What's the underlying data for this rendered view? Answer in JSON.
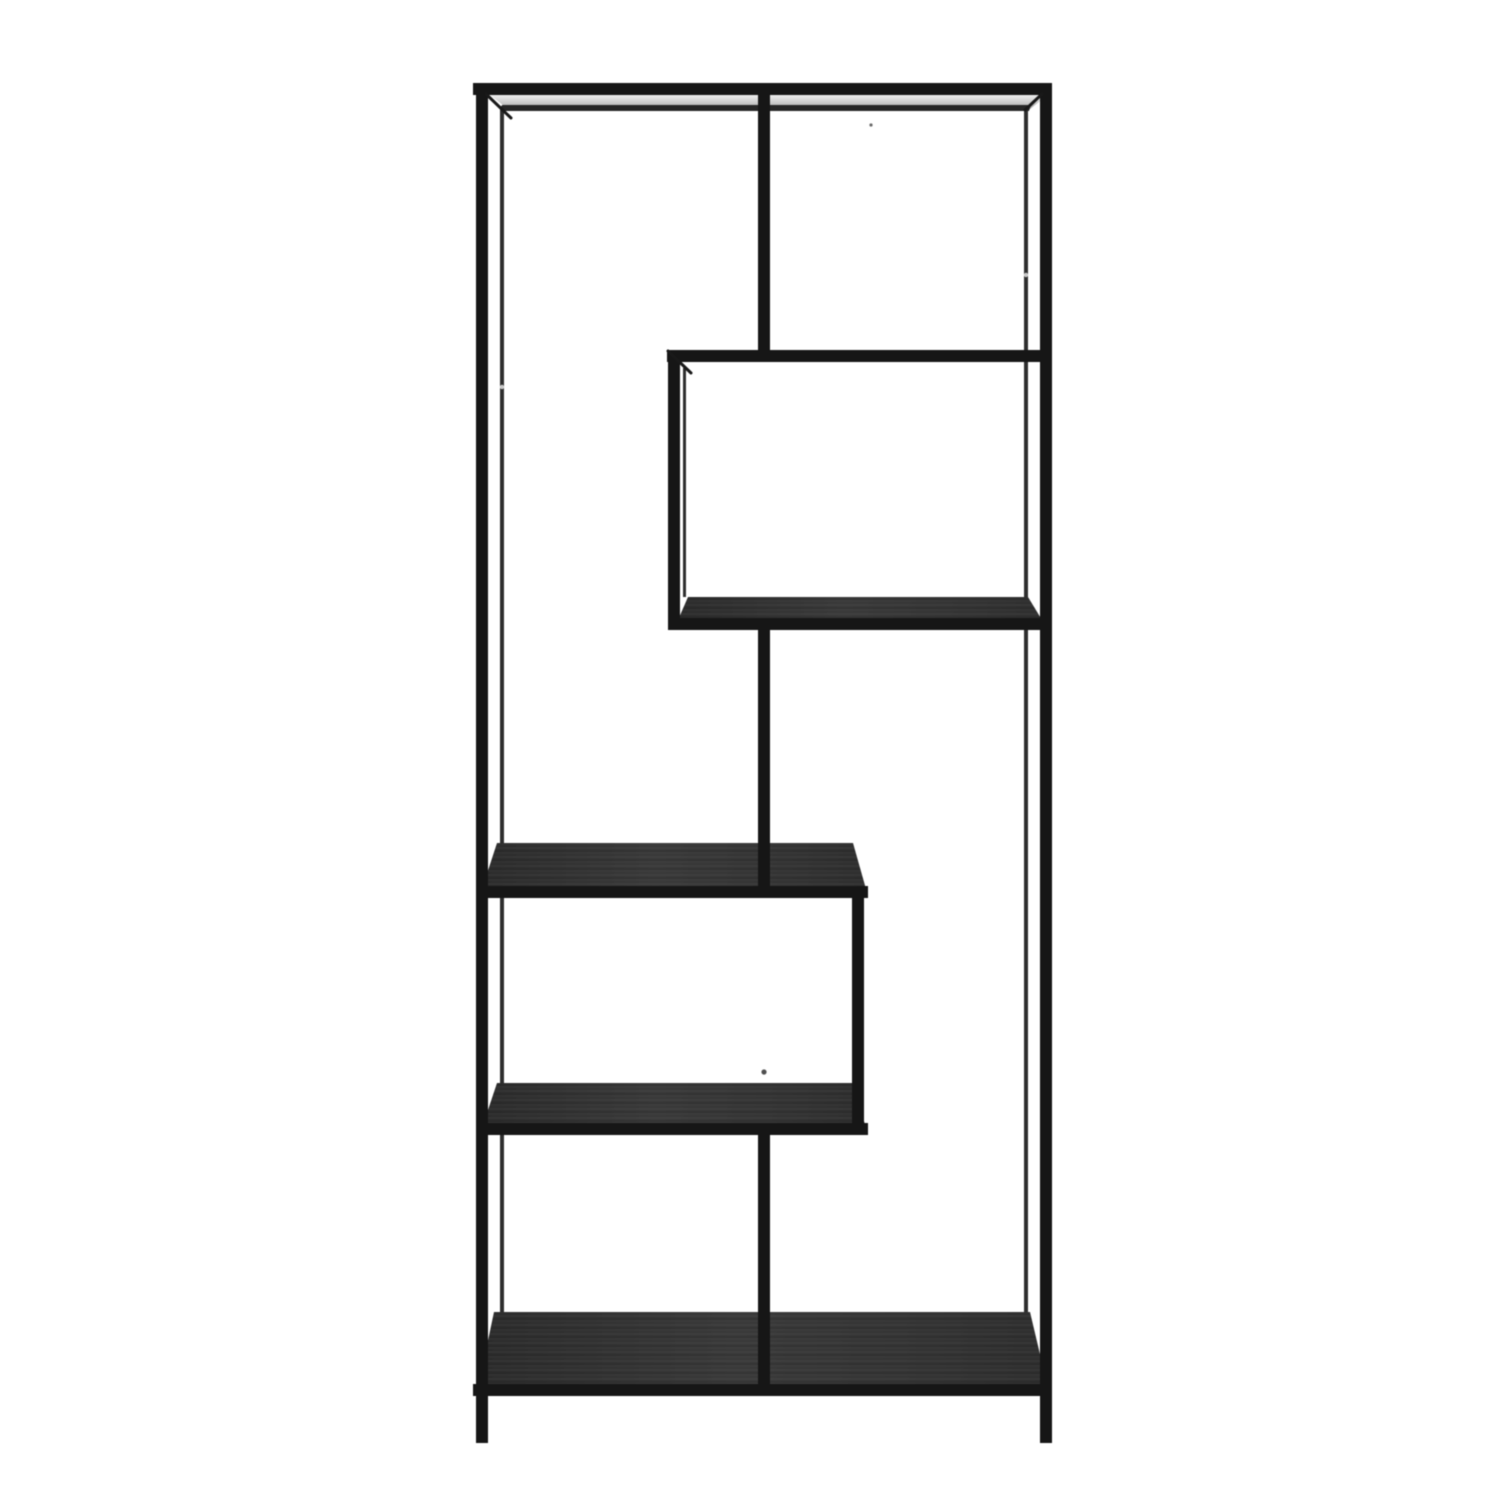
{
  "scene": {
    "subject": "black-metal-asymmetric-shelving-unit-product-photo",
    "background_color": "#ffffff",
    "frame_color": "#161616",
    "back_frame_color": "#2e2e2e",
    "wood_color_dark": "#2c2c2c",
    "wood_color_light": "#3a3a3a",
    "top_strip_light": "#efefef",
    "top_strip_dark": "#a3a3a3",
    "canvas": {
      "width": 1500,
      "height": 1500
    },
    "elements": {
      "rects": [
        {
          "name": "back-left-post",
          "layer": "back",
          "x": 500,
          "y": 106,
          "w": 4,
          "h": 1206,
          "color": "#2e2e2e"
        },
        {
          "name": "back-right-post",
          "layer": "back",
          "x": 1024,
          "y": 106,
          "w": 4,
          "h": 1206,
          "color": "#2e2e2e"
        },
        {
          "name": "cube-left-back-edge",
          "layer": "back",
          "x": 683,
          "y": 368,
          "w": 3,
          "h": 229,
          "color": "#2e2e2e"
        },
        {
          "name": "top-rail",
          "layer": "front",
          "x": 473,
          "y": 83,
          "w": 579,
          "h": 12
        },
        {
          "name": "left-post",
          "layer": "front",
          "x": 476,
          "y": 83,
          "w": 12,
          "h": 1360
        },
        {
          "name": "right-post",
          "layer": "front",
          "x": 1040,
          "y": 83,
          "w": 12,
          "h": 1360
        },
        {
          "name": "center-divider-upper",
          "layer": "front",
          "x": 758,
          "y": 92,
          "w": 12,
          "h": 264
        },
        {
          "name": "cube-top-rail",
          "layer": "front",
          "x": 667,
          "y": 350,
          "w": 385,
          "h": 12
        },
        {
          "name": "cube-left-post",
          "layer": "front",
          "x": 668,
          "y": 356,
          "w": 12,
          "h": 274
        },
        {
          "name": "cube-shelf-front-rail",
          "layer": "front",
          "x": 668,
          "y": 618,
          "w": 384,
          "h": 12
        },
        {
          "name": "center-divider-middle",
          "layer": "front",
          "x": 758,
          "y": 626,
          "w": 12,
          "h": 272
        },
        {
          "name": "middle-shelf-front-rail",
          "layer": "front",
          "x": 480,
          "y": 886,
          "w": 388,
          "h": 12
        },
        {
          "name": "right-support-post",
          "layer": "front",
          "x": 852,
          "y": 892,
          "w": 12,
          "h": 243
        },
        {
          "name": "lower-shelf-front-rail",
          "layer": "front",
          "x": 480,
          "y": 1123,
          "w": 388,
          "h": 12
        },
        {
          "name": "center-divider-lower",
          "layer": "front",
          "x": 758,
          "y": 1131,
          "w": 12,
          "h": 265
        },
        {
          "name": "bottom-front-rail",
          "layer": "front",
          "x": 473,
          "y": 1384,
          "w": 579,
          "h": 12
        }
      ],
      "surfaces": [
        {
          "name": "top-shelf-surface",
          "fill": "strip",
          "points": [
            [
              490,
              95
            ],
            [
              1048,
              95
            ],
            [
              1030,
              109
            ],
            [
              508,
              109
            ]
          ]
        },
        {
          "name": "top-shelf-edge-line",
          "fill": "#262626",
          "points": [
            [
              502,
              105
            ],
            [
              1031,
              105
            ],
            [
              1029,
              111
            ],
            [
              500,
              111
            ]
          ]
        },
        {
          "name": "cube-shelf-surface",
          "fill": "wood",
          "points": [
            [
              688,
              597
            ],
            [
              1028,
              597
            ],
            [
              1042,
              620
            ],
            [
              678,
              620
            ]
          ]
        },
        {
          "name": "middle-shelf-surface",
          "fill": "wood",
          "points": [
            [
              497,
              843
            ],
            [
              853,
              843
            ],
            [
              866,
              889
            ],
            [
              482,
              889
            ]
          ]
        },
        {
          "name": "lower-shelf-surface",
          "fill": "wood",
          "points": [
            [
              497,
              1083
            ],
            [
              853,
              1083
            ],
            [
              866,
              1128
            ],
            [
              482,
              1128
            ]
          ]
        },
        {
          "name": "bottom-shelf-surface",
          "fill": "wood",
          "points": [
            [
              494,
              1312
            ],
            [
              1030,
              1312
            ],
            [
              1048,
              1388
            ],
            [
              478,
              1388
            ]
          ]
        }
      ],
      "lines": [
        {
          "name": "top-left-depth-edge",
          "x1": 486,
          "y1": 94,
          "x2": 511,
          "y2": 118,
          "stroke": "#191919",
          "w": 3
        },
        {
          "name": "top-right-depth-edge",
          "x1": 1042,
          "y1": 94,
          "x2": 1025,
          "y2": 110,
          "stroke": "#191919",
          "w": 3
        },
        {
          "name": "cube-top-left-depth-edge",
          "x1": 668,
          "y1": 351,
          "x2": 691,
          "y2": 373,
          "stroke": "#191919",
          "w": 3
        }
      ],
      "dots": [
        {
          "name": "screw-dot-left",
          "cx": 502,
          "cy": 387,
          "r": 2.2,
          "fill": "#c9c9c9"
        },
        {
          "name": "screw-dot-right",
          "cx": 1026,
          "cy": 275,
          "r": 2.2,
          "fill": "#c9c9c9"
        },
        {
          "name": "screw-dot-center",
          "cx": 764,
          "cy": 1072,
          "r": 2.6,
          "fill": "#4f4f4f"
        },
        {
          "name": "strip-screw-dot",
          "cx": 871,
          "cy": 125,
          "r": 1.6,
          "fill": "#6a6a6a"
        }
      ]
    }
  }
}
